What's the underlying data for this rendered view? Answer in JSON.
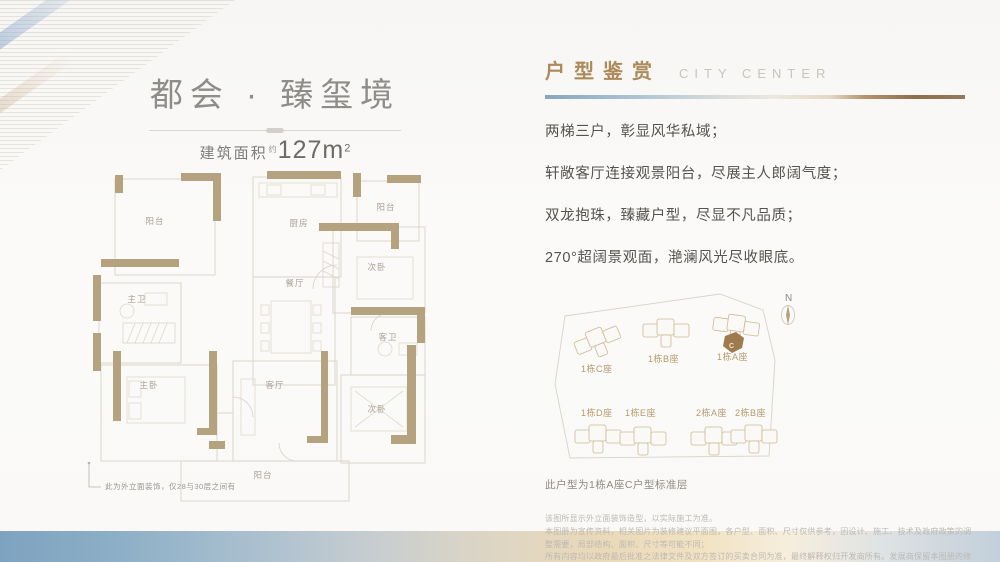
{
  "left_panel": {
    "title": "都会 · 臻玺境",
    "area_label": "建筑面积",
    "area_approx": "约",
    "area_number": "127m",
    "area_exponent": "2",
    "rooms": [
      {
        "label": "阳台"
      },
      {
        "label": "厨房"
      },
      {
        "label": "阳台"
      },
      {
        "label": "次卧"
      },
      {
        "label": "餐厅"
      },
      {
        "label": "主卫"
      },
      {
        "label": "客卫"
      },
      {
        "label": "主卧"
      },
      {
        "label": "客厅"
      },
      {
        "label": "次卧"
      },
      {
        "label": "阳台"
      }
    ],
    "facade_note": "此为外立面装饰，仅28与30层之间有"
  },
  "right_panel": {
    "section_title_cn": "户型鉴赏",
    "section_title_en": "CITY CENTER",
    "selling_points": [
      "两梯三户，彰显风华私域；",
      "轩敞客厅连接观景阳台，尽展主人郎阔气度；",
      "双龙抱珠，臻藏户型，尽显不凡品质；",
      "270°超阔景观面，滟澜风光尽收眼底。"
    ],
    "site_plan": {
      "compass": "N",
      "buildings": [
        {
          "name": "1栋C座"
        },
        {
          "name": "1栋B座"
        },
        {
          "name": "1栋A座"
        },
        {
          "name": "1栋D座"
        },
        {
          "name": "1栋E座"
        },
        {
          "name": "2栋A座"
        },
        {
          "name": "2栋B座"
        }
      ],
      "highlight_unit": "C",
      "caption": "此户型为1栋A座C户型标准层"
    },
    "disclaimer": [
      "该图所显示外立面装饰造型，以实际施工为准。",
      "本图册为宣传资料，相关图片为装修建议平面图，各户型、面积、尺寸仅供参考，因设计、施工、技术及政府政策的调整需要，局部结构、面积、尺寸等可能不同；",
      "所有内容均以政府最后批准之法律文件及双方签订的买卖合同为准，最终解释权归开发商所有。发展商保留本图册的修改权利，敬请留意最新资料。"
    ]
  },
  "colors": {
    "accent_tan": "#b49a6e",
    "wall_tan": "#b5a27f",
    "band_blue": "#7ea3c0",
    "band_beige": "#ead9b8"
  }
}
